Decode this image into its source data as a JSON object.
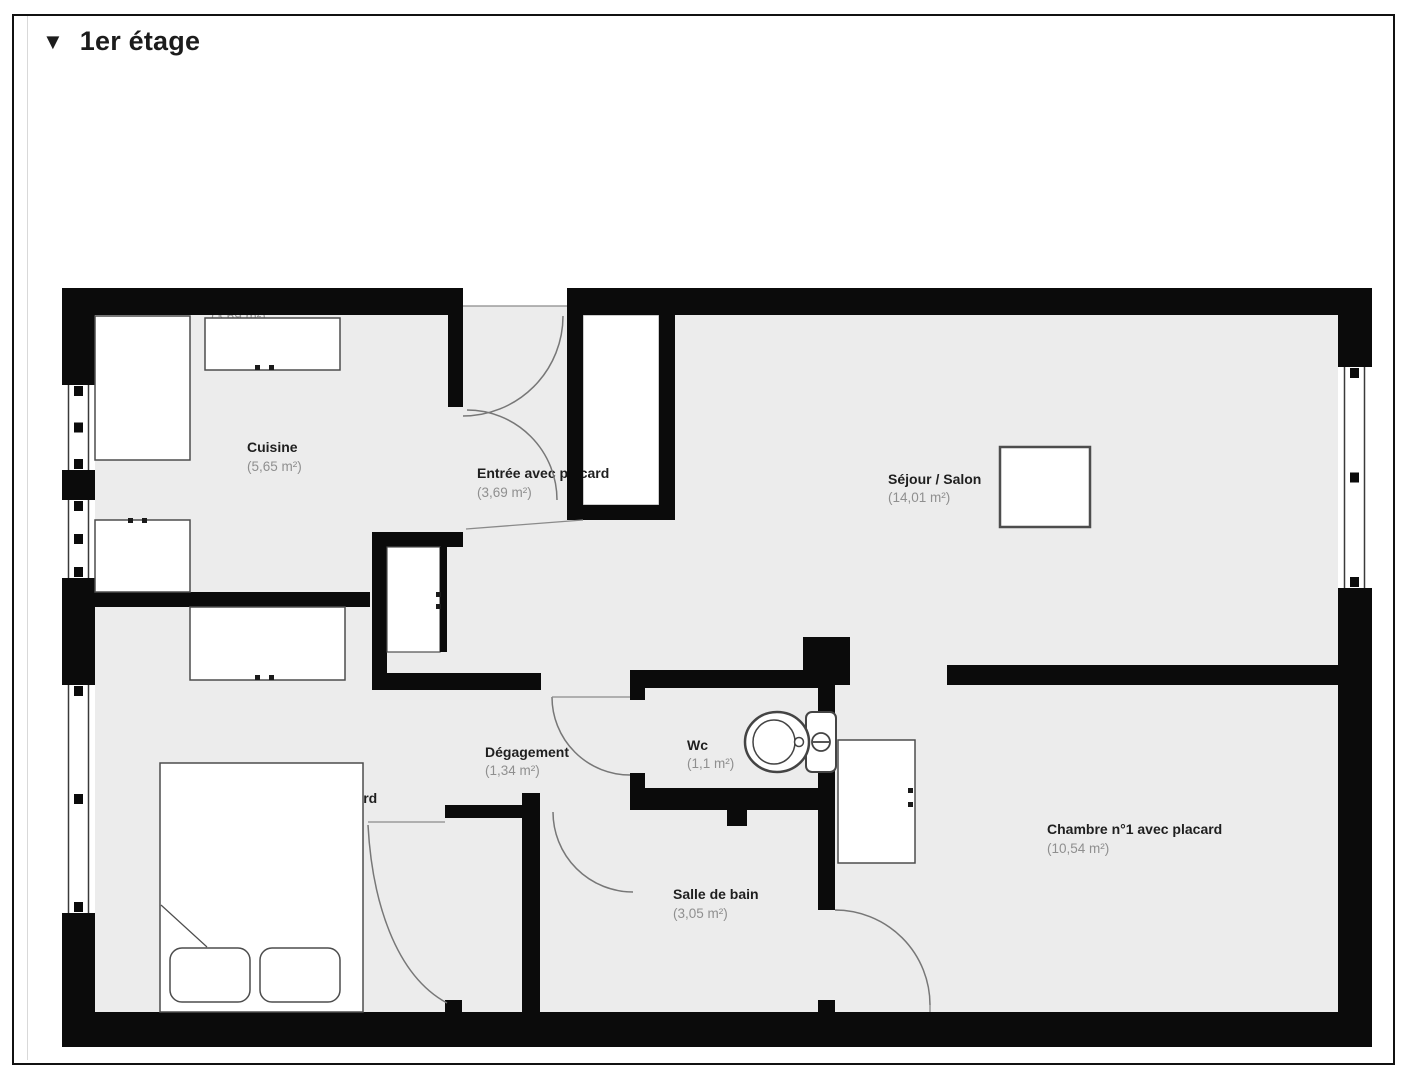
{
  "header": {
    "collapse_icon": "▼",
    "title": "1er étage"
  },
  "floor_plan": {
    "stray_area_label": "(3,69 m²)",
    "rooms": [
      {
        "id": "cuisine",
        "name": "Cuisine",
        "size": "(5,65 m²)"
      },
      {
        "id": "entree",
        "name": "Entrée avec placard",
        "size": "(3,69 m²)"
      },
      {
        "id": "sejour",
        "name": "Séjour / Salon",
        "size": "(14,01 m²)"
      },
      {
        "id": "degagement",
        "name": "Dégagement",
        "size": "(1,34 m²)"
      },
      {
        "id": "wc",
        "name": "Wc",
        "size": "(1,1 m²)"
      },
      {
        "id": "chambre2",
        "name": "Chambre n°2 avec placard",
        "size": "(9,96 m²)"
      },
      {
        "id": "salle_de_bain",
        "name": "Salle de bain",
        "size": "(3,05 m²)"
      },
      {
        "id": "chambre1",
        "name": "Chambre n°1 avec placard",
        "size": "(10,54 m²)"
      }
    ],
    "colors": {
      "wall": "#0b0b0b",
      "floor": "#ececec",
      "furniture_outline": "#4d4d4d",
      "door_arc": "#777777",
      "room_name_text": "#1f1f1f",
      "room_size_text": "#8f8f8f"
    }
  }
}
